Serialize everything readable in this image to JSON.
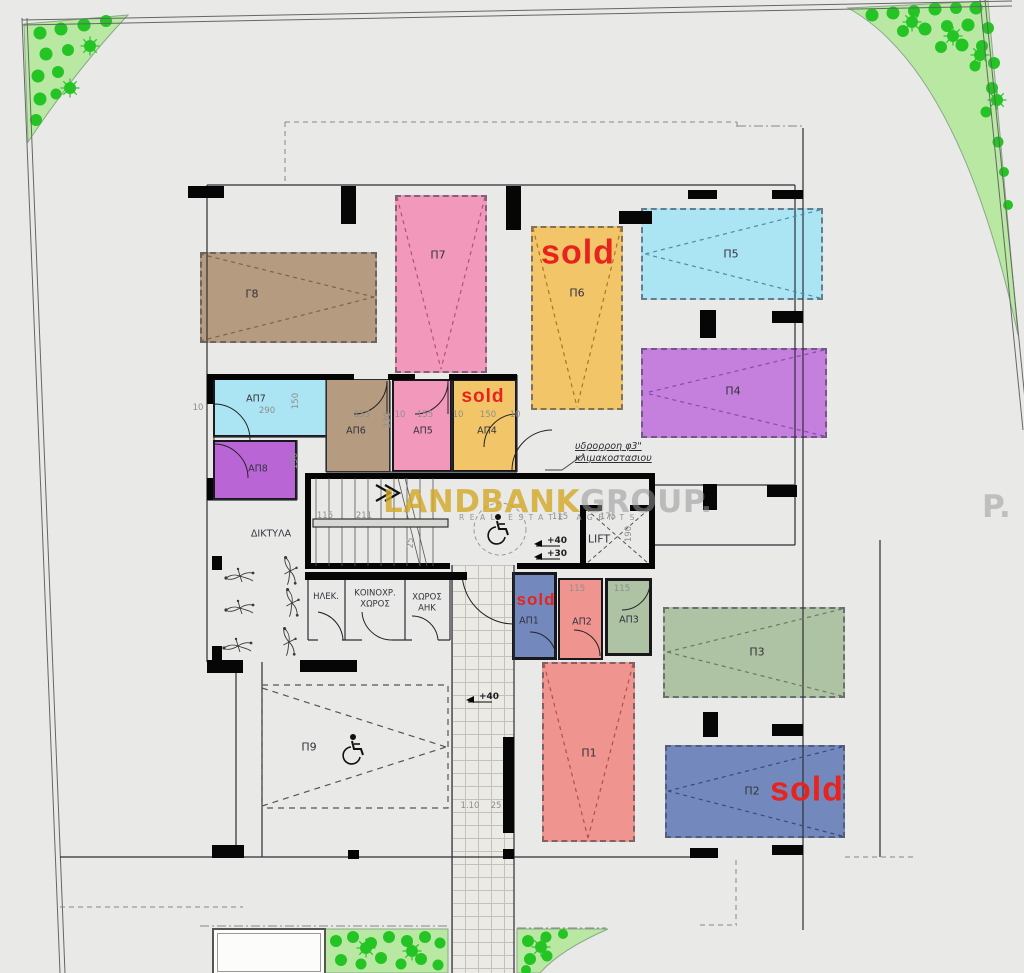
{
  "watermark": {
    "primary": "LANDBANK",
    "secondary": "GROUP.",
    "tagline": "REAL ESTATE AGENTS",
    "fragment": "P."
  },
  "sold_label": "sold",
  "parking": {
    "g8": "Γ8",
    "p7": "Π7",
    "p6": "Π6",
    "p5": "Π5",
    "p4": "Π4",
    "p3": "Π3",
    "p2": "Π2",
    "p1": "Π1",
    "p9": "Π9"
  },
  "sold_spaces": [
    "Π6",
    "Π2",
    "ΑΠ1",
    "ΑΠ4"
  ],
  "storage": {
    "ap1": "ΑΠ1",
    "ap2": "ΑΠ2",
    "ap3": "ΑΠ3",
    "ap4": "ΑΠ4",
    "ap5": "ΑΠ5",
    "ap6": "ΑΠ6",
    "ap7": "ΑΠ7",
    "ap8": "ΑΠ8"
  },
  "rooms": {
    "elek": "ΗΛΕΚ.",
    "common": "ΚΟΙΝΟΧΡ.\nΧΩΡΟΣ",
    "ahk": "ΧΩΡΟΣ\nΑΗΚ",
    "lift": "LIFT",
    "networks": "ΔΙΚΤΥΛΑ"
  },
  "notes": {
    "downpipe": "υδρορροη  φ3\"\nκλιμακοστασιου"
  },
  "levels": {
    "core_upper": "+40",
    "core_lower": "+30",
    "walkway": "+40"
  },
  "dims": {
    "d10a": "10",
    "d290": "290",
    "d150v_ap7": "150",
    "d155_ap6": "155",
    "d230": "230",
    "d10b": "10",
    "d155_ap5": "155",
    "d10c": "10",
    "d150_ap4": "150",
    "d10d": "10",
    "d150v_ap8": "150",
    "stair_a": "115",
    "stair_b": "211",
    "stair_c": "25",
    "lift_a": "115",
    "lift_w": "175",
    "lift_h": "190",
    "ap2_w": "115",
    "ap3_w": "115",
    "walk_a": "1.10",
    "walk_b": "25"
  },
  "colors": {
    "sold_red": "#e8231d",
    "tan": "#b59b80",
    "pink": "#f298ba",
    "yellow": "#f2c569",
    "cyan": "#abe4f2",
    "purple": "#c57fdc",
    "violet": "#b965d6",
    "blue": "#7389bd",
    "salmon": "#f0948f",
    "sage": "#aec2a4",
    "green_area": "#b9e8a3",
    "bush_green": "#24c424",
    "watermark_gold": "#d2a826"
  }
}
